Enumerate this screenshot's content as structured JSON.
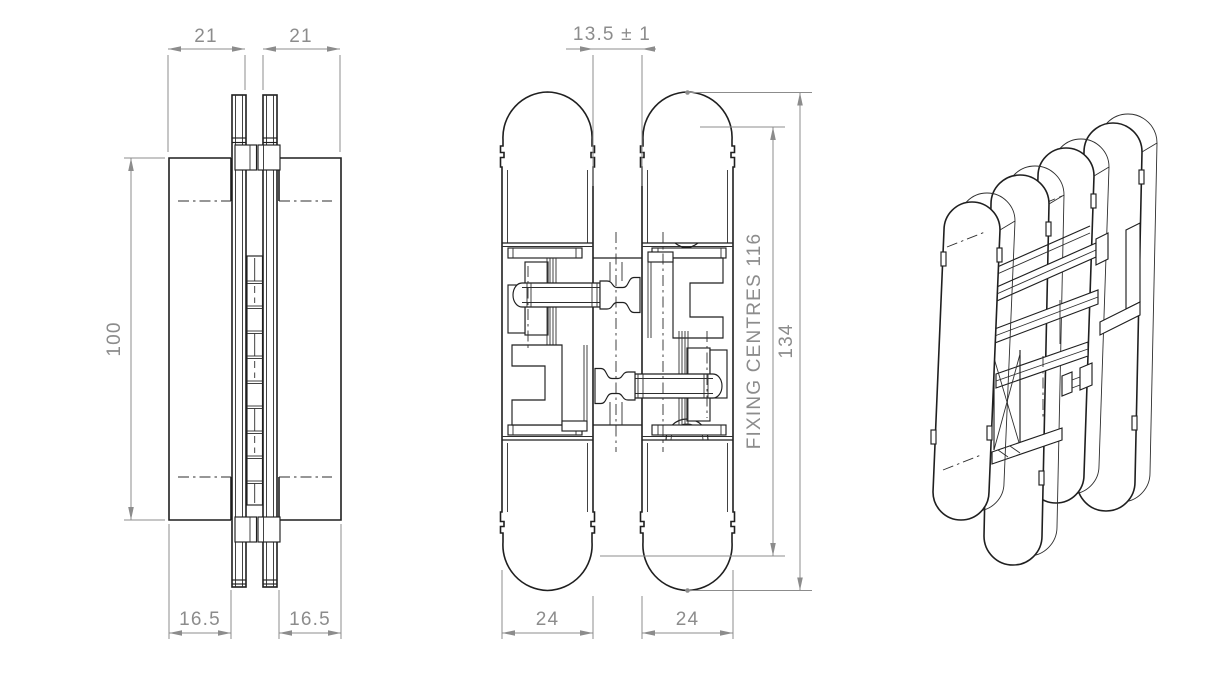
{
  "drawing": {
    "type": "technical-drawing",
    "subject": "concealed-hinge",
    "colors": {
      "background": "#ffffff",
      "object_line": "#1f1f1f",
      "dimension": "#8c8c8c"
    },
    "views": {
      "side": {
        "dim_top_left": "21",
        "dim_top_right": "21",
        "dim_height": "100",
        "dim_bottom_left": "16.5",
        "dim_bottom_right": "16.5"
      },
      "front": {
        "dim_gap": "13.5 ± 1",
        "dim_fixing_centres": "FIXING CENTRES 116",
        "dim_overall_height": "134",
        "dim_bottom_left": "24",
        "dim_bottom_right": "24"
      },
      "isometric": {}
    }
  }
}
